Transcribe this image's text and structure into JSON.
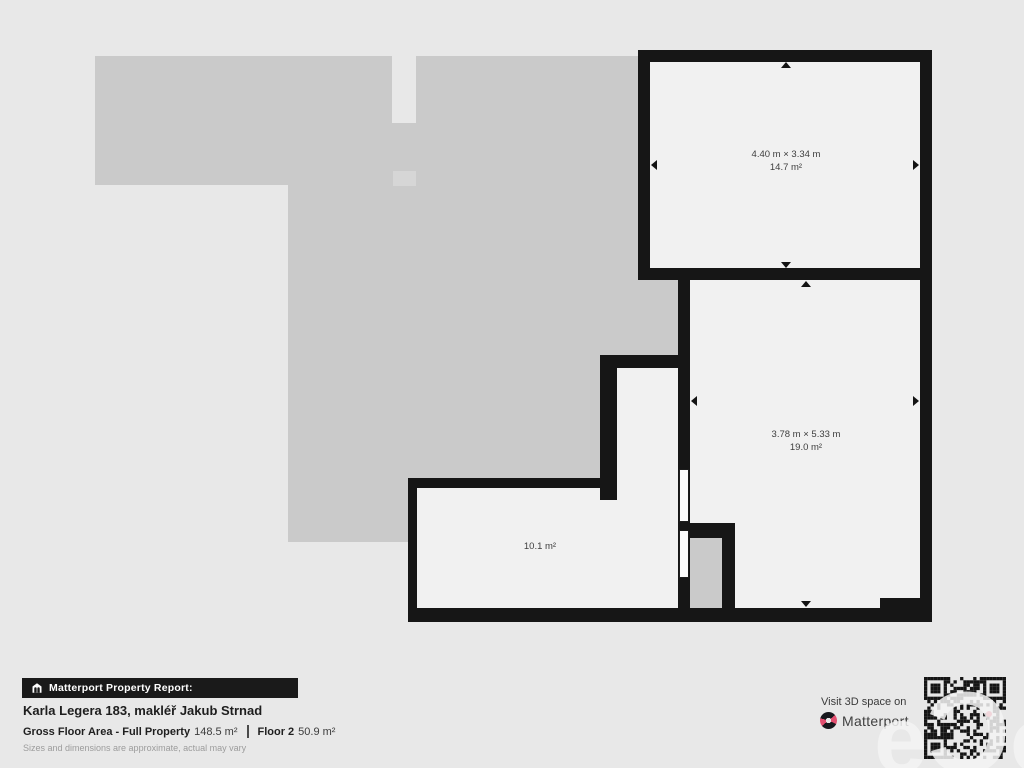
{
  "plan": {
    "rooms": [
      {
        "dimensions": "4.40 m × 3.34 m",
        "area": "14.7 m²"
      },
      {
        "dimensions": "3.78 m × 5.33 m",
        "area": "19.0 m²"
      },
      {
        "dimensions": "",
        "area": "10.1 m²"
      }
    ]
  },
  "footer": {
    "badge_label": "Matterport Property Report:",
    "title": "Karla Legera 183, makléř Jakub Strnad",
    "gfa_label": "Gross Floor Area - Full Property",
    "gfa_value": "148.5 m²",
    "floor_label": "Floor 2",
    "floor_value": "50.9 m²",
    "disclaimer": "Sizes and dimensions are approximate, actual may vary",
    "visit_label": "Visit 3D space on",
    "brand_name": "Matterport"
  },
  "watermark": {
    "letter_1": "e",
    "letter_2": "Ɔ",
    "letter_3": "o"
  },
  "colors": {
    "background": "#e8e8e8",
    "wall": "#161616",
    "floor": "#f1f1f1",
    "lower_floor_silhouette": "#cacaca",
    "brand_accent": "#e24f70"
  }
}
